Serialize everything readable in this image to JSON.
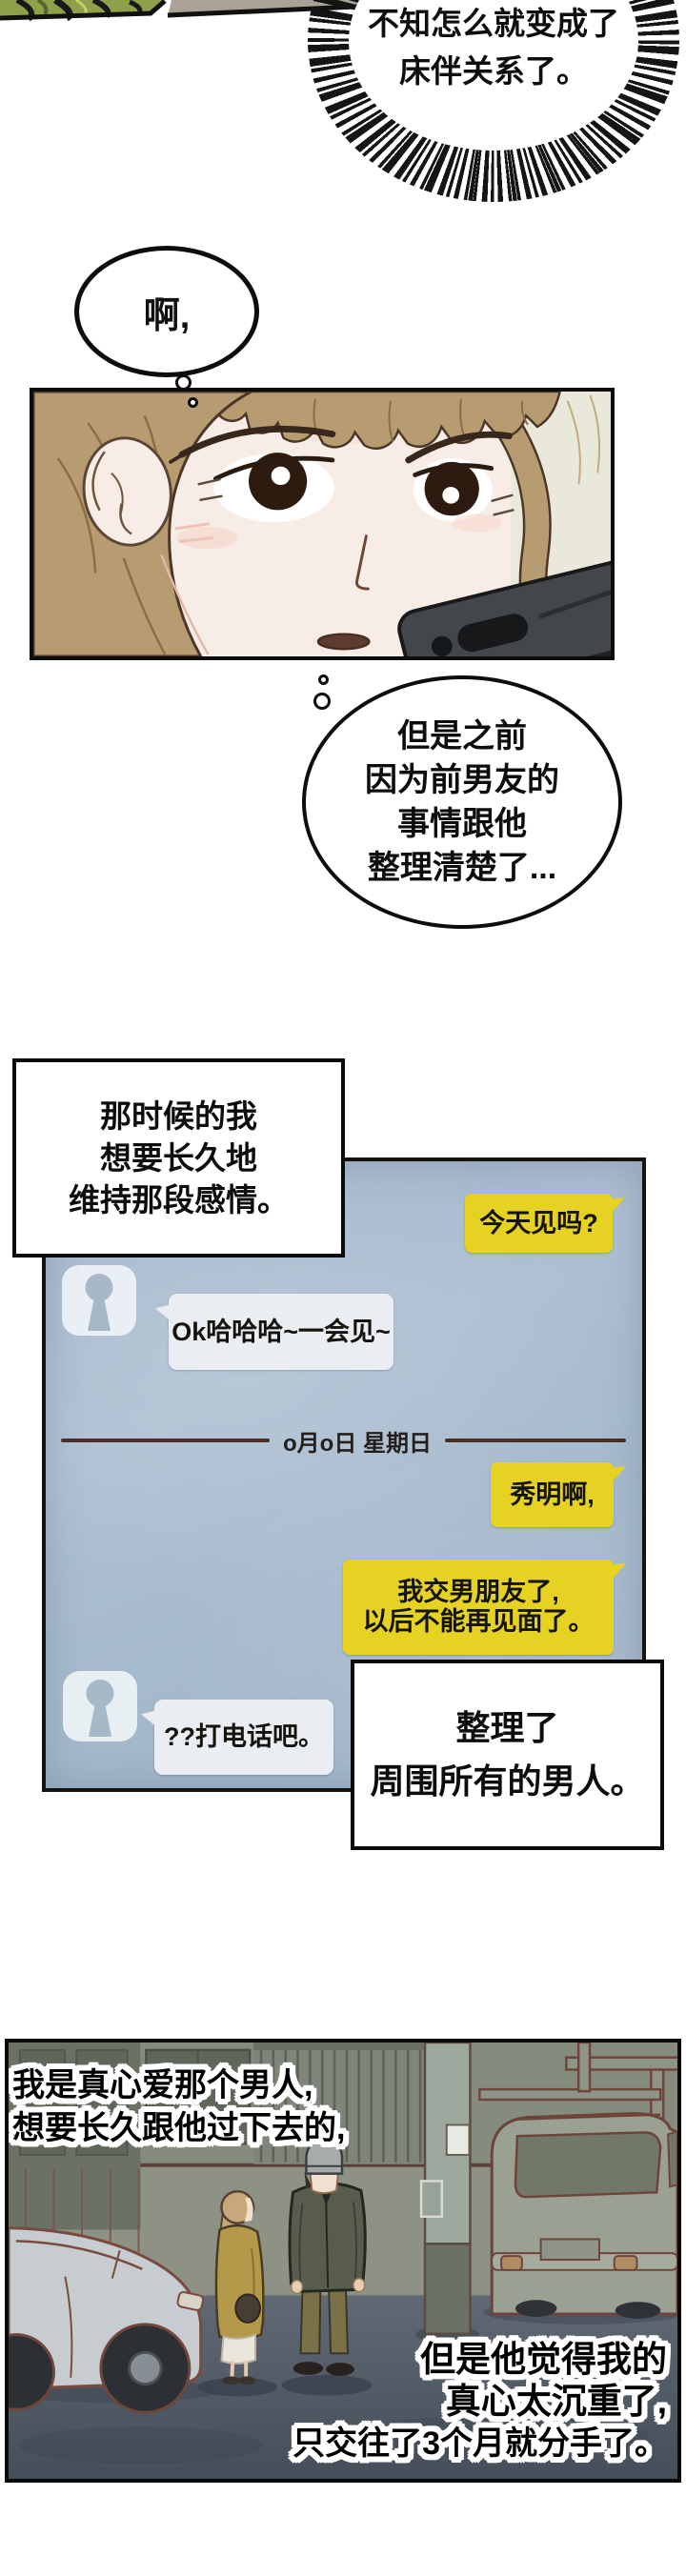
{
  "top_burst": {
    "line1": "不知怎么就变成了",
    "line2": "床伴关系了。"
  },
  "ah_bubble": {
    "text": "啊,"
  },
  "thought_bubble": {
    "line1": "但是之前",
    "line2": "因为前男友的",
    "line3": "事情跟他",
    "line4": "整理清楚了..."
  },
  "caption_past": {
    "line1": "那时候的我",
    "line2": "想要长久地",
    "line3": "维持那段感情。"
  },
  "chat": {
    "message_sent_1": "今天见吗?",
    "message_received_1": "Ok哈哈哈~一会见~",
    "date_divider": "o月o日 星期日",
    "message_sent_2": "秀明啊,",
    "message_sent_3_line1": "我交男朋友了,",
    "message_sent_3_line2": "以后不能再见面了。",
    "message_received_2": "??打电话吧。"
  },
  "caption_cleanup": {
    "line1": "整理了",
    "line2": "周围所有的男人。"
  },
  "street": {
    "caption_love_line1": "我是真心爱那个男人,",
    "caption_love_line2": "想要长久跟他过下去的,",
    "caption_breakup_line1": "但是他觉得我的",
    "caption_breakup_line2": "真心太沉重了,",
    "caption_breakup_line3": "只交往了3个月就分手了。"
  },
  "colors": {
    "bubble_yellow": "#e6d222",
    "chat_panel_blue": "#a9bccf",
    "received_bubble": "#eaedf2",
    "divider_line": "#4b2e28",
    "panel_border": "#0d0d0d",
    "hair_brown": "#b69c70",
    "street_wall": "#858b7d"
  }
}
